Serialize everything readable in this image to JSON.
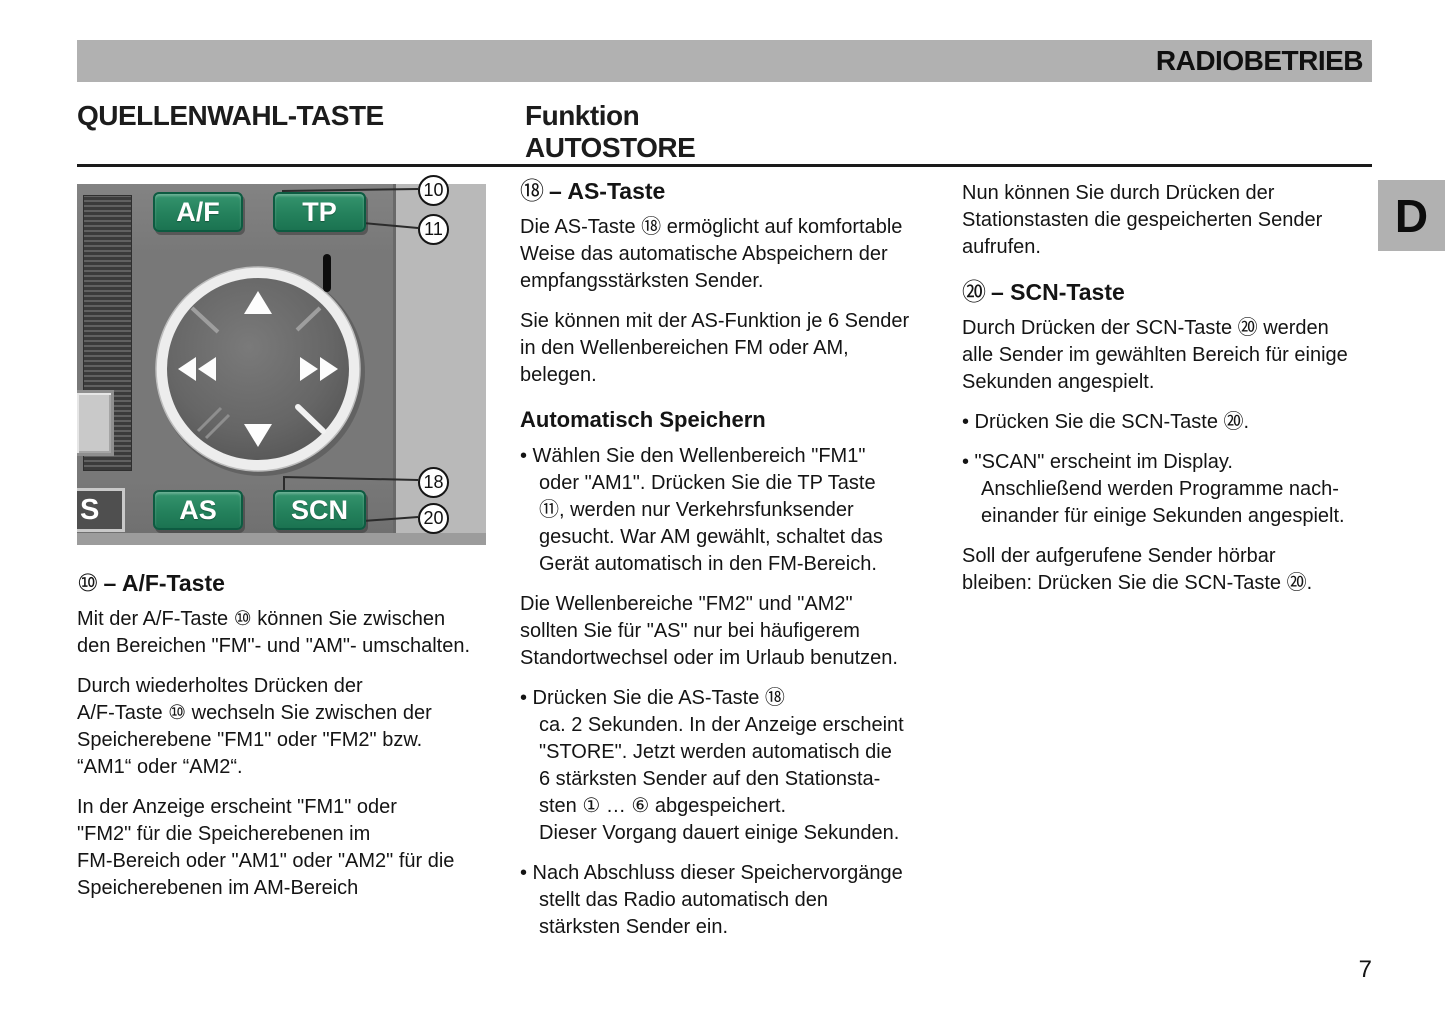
{
  "header": {
    "title": "RADIOBETRIEB",
    "tab": "D"
  },
  "headings": {
    "left": "QUELLENWAHL-TASTE",
    "mid_line1": "Funktion",
    "mid_line2": "AUTOSTORE"
  },
  "illustration": {
    "buttons": {
      "af": "A/F",
      "tp": "TP",
      "as": "AS",
      "scn": "SCN"
    },
    "partial_button_label": "S",
    "callouts": {
      "c10": "10",
      "c11": "11",
      "c18": "18",
      "c20": "20"
    },
    "colors": {
      "button_green": "#24815c",
      "panel_gray": "#787878",
      "background_gray": "#b9b9b9"
    }
  },
  "columns": {
    "left": {
      "heading_num": "⑩",
      "heading_text": "– A/F-Taste",
      "para1": "Mit der A/F-Taste ⑩ können Sie zwischen\nden Bereichen \"FM\"- und \"AM\"- umschalten.",
      "para2": "Durch wiederholtes Drücken der\nA/F-Taste ⑩ wechseln Sie zwischen der\nSpeicherebene \"FM1\" oder \"FM2\" bzw.\n“AM1“ oder “AM2“.",
      "para3": "In der Anzeige erscheint \"FM1\" oder\n\"FM2\" für die Speicherebenen im\nFM-Bereich oder \"AM1\" oder \"AM2\" für die\nSpeicherebenen im AM-Bereich"
    },
    "middle": {
      "heading_num": "⑱",
      "heading_text": "– AS-Taste",
      "para1": "Die AS-Taste ⑱ ermöglicht auf komfortable\nWeise das automatische Abspeichern der\nempfangsstärksten Sender.",
      "para2": "Sie können mit der AS-Funktion je 6 Sender\nin den Wellenbereichen FM oder AM,\nbelegen.",
      "subheading": "Automatisch Speichern",
      "bullet1": "• Wählen Sie den Wellenbereich \"FM1\"\noder \"AM1\". Drücken Sie die TP Taste\n⑪, werden nur Verkehrsfunksender\ngesucht. War AM gewählt, schaltet das\nGerät automatisch in den FM-Bereich.",
      "para3": "Die Wellenbereiche \"FM2\" und \"AM2\"\nsollten Sie für \"AS\" nur bei häufigerem\nStandortwechsel oder im Urlaub benutzen.",
      "bullet2": "• Drücken Sie die AS-Taste ⑱\nca. 2 Sekunden. In der Anzeige erscheint\n\"STORE\". Jetzt werden automatisch die\n6 stärksten Sender auf den Stationsta-\nsten ① … ⑥ abgespeichert.\nDieser Vorgang dauert einige Sekunden.",
      "bullet3": "• Nach Abschluss dieser Speichervorgänge\nstellt das Radio automatisch den\nstärksten Sender ein."
    },
    "right": {
      "para1": "Nun können Sie durch Drücken der\nStationstasten die gespeicherten Sender\naufrufen.",
      "heading_num": "⑳",
      "heading_text": "– SCN-Taste",
      "para2": "Durch Drücken der SCN-Taste ⑳ werden\nalle Sender im gewählten Bereich für einige\nSekunden angespielt.",
      "bullet1": "• Drücken Sie die SCN-Taste ⑳.",
      "bullet2": "• \"SCAN\" erscheint im Display.\nAnschließend werden Programme nach-\neinander für einige Sekunden angespielt.",
      "para3": "Soll der aufgerufene Sender hörbar\nbleiben: Drücken Sie die SCN-Taste ⑳."
    }
  },
  "footer": {
    "page_number": "7"
  }
}
